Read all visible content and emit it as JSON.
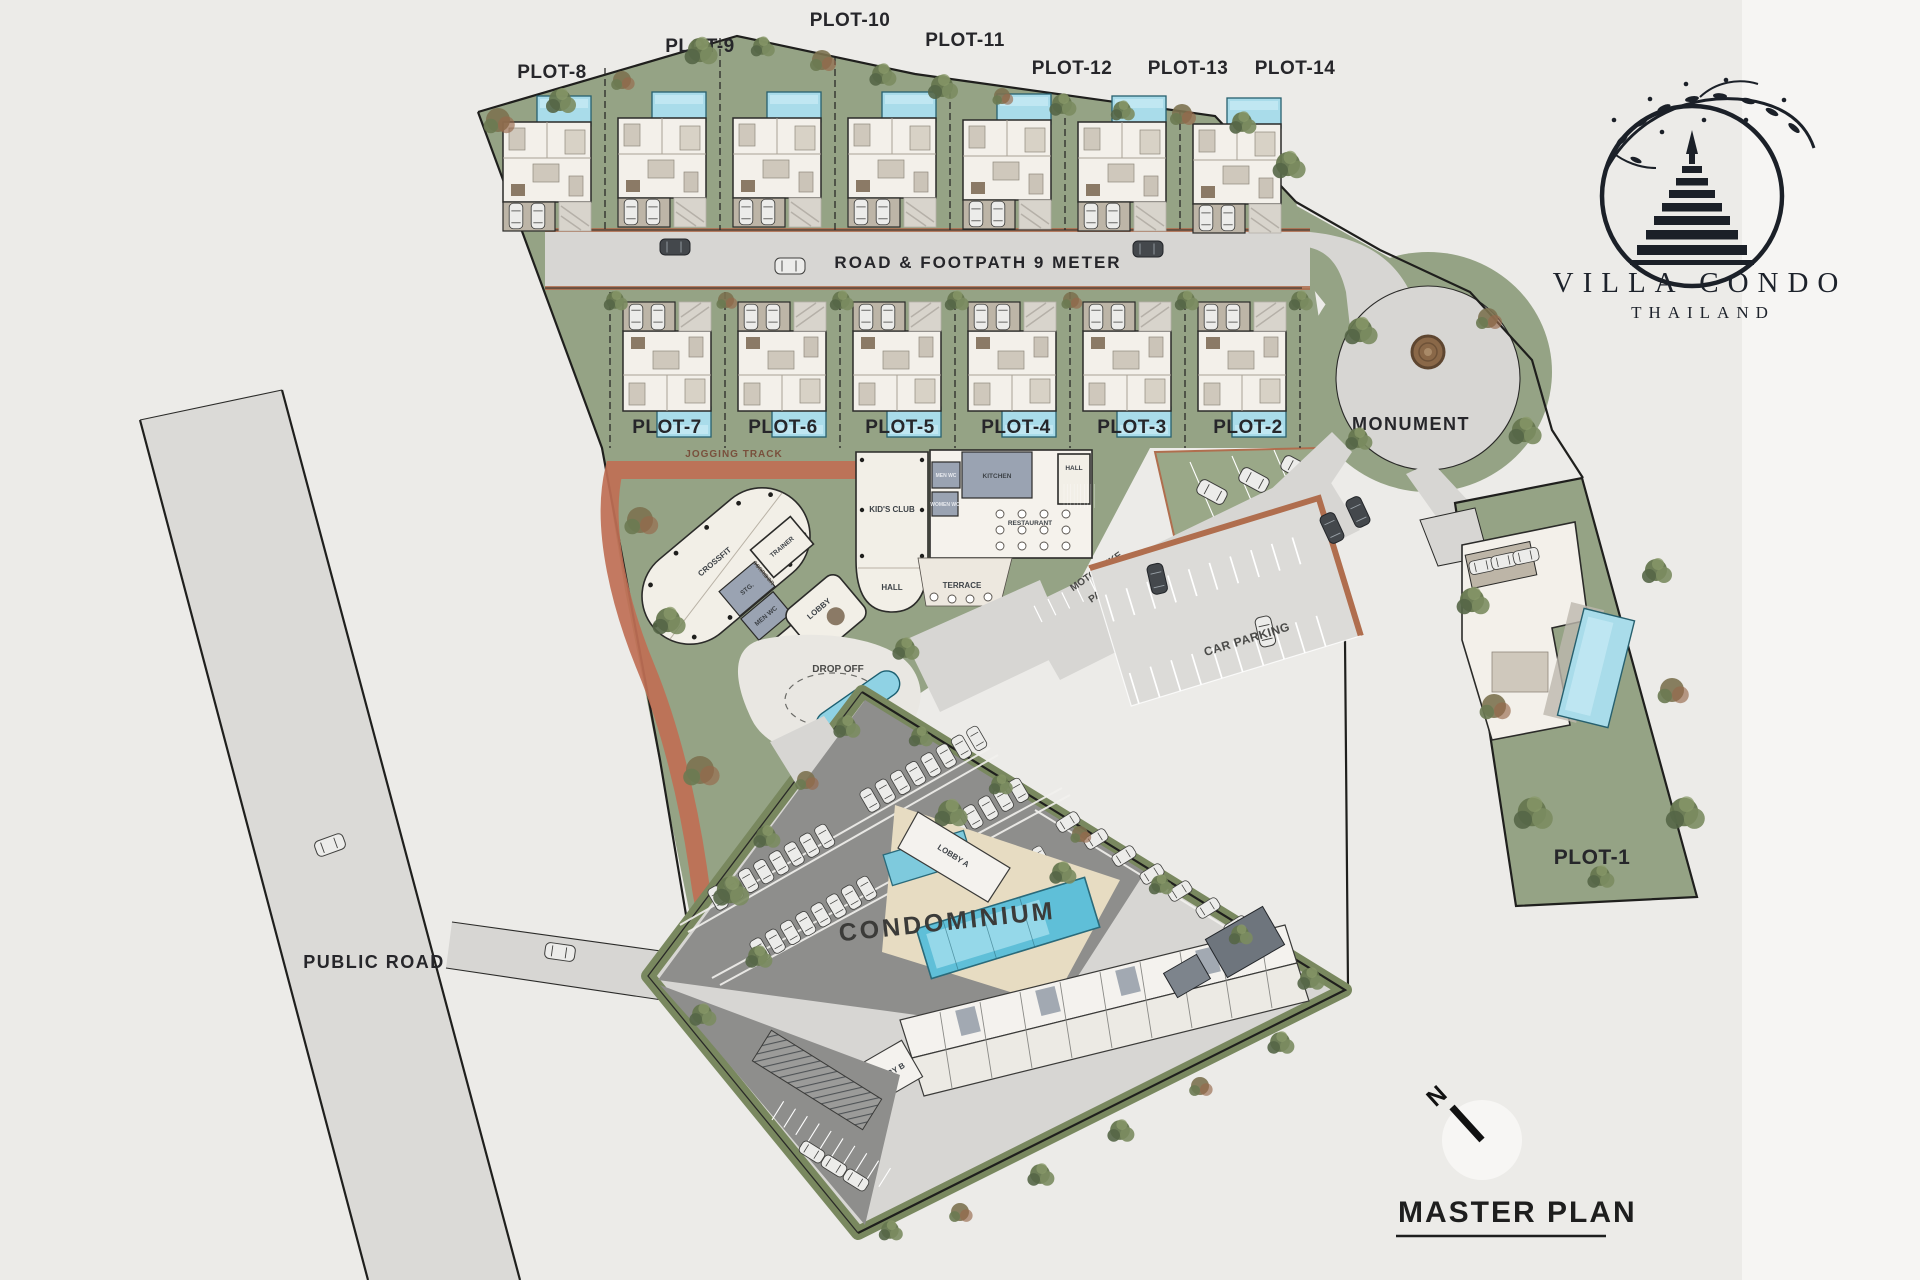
{
  "branding": {
    "name": "VILLA CONDO",
    "country": "THAILAND"
  },
  "title": {
    "text": "MASTER PLAN"
  },
  "compass": {
    "north": "N"
  },
  "roads": {
    "main": "ROAD & FOOTPATH 9 METER",
    "public": "PUBLIC ROAD"
  },
  "areas": {
    "monument": "MONUMENT",
    "condominium": "CONDOMINIUM",
    "car_parking": "CAR PARKING",
    "motorbike_line1": "MOTORBIKE",
    "motorbike_line2": "PARKING",
    "drop_off": "DROP OFF",
    "jogging_track": "JOGGING TRACK",
    "terrace": "TERRACE"
  },
  "club": {
    "kids_club": "KID'S CLUB",
    "hall": "HALL",
    "kitchen": "KITCHEN",
    "restaurant": "RESTAURANT",
    "crossfit": "CROSSFIT",
    "trainer": "TRAINER",
    "storage": "STG.",
    "men_wc": "MEN WC",
    "women_wc": "WOMEN WC",
    "office": "OFFICE",
    "lobby": "LOBBY",
    "corridor": "CORRIDOR"
  },
  "condo": {
    "lobby_a": "LOBBY A",
    "lobby_b": "LOBBY B"
  },
  "plots": {
    "top_row": [
      "PLOT-8",
      "PLOT-9",
      "PLOT-10",
      "PLOT-11",
      "PLOT-12",
      "PLOT-13",
      "PLOT-14"
    ],
    "middle_row": [
      "PLOT-7",
      "PLOT-6",
      "PLOT-5",
      "PLOT-4",
      "PLOT-3",
      "PLOT-2"
    ],
    "estate": "PLOT-1"
  },
  "colors": {
    "bg": "#ECEBE8",
    "paper_seam": "#F6F5F3",
    "site_green": "#95A385",
    "green_dark": "#66774F",
    "road": "#D7D6D3",
    "asphalt": "#8E8E8C",
    "curb": "#B06E4E",
    "track": "#BF6F55",
    "pool": "#A9DCEA",
    "pool_deep": "#5FBFD8",
    "cream": "#F2EFE7",
    "slate": "#9AA3B2",
    "sand": "#E7DCC2",
    "ink": "#26262A",
    "white_car": "#ECECEA",
    "monument_brown": "#8A6848"
  }
}
